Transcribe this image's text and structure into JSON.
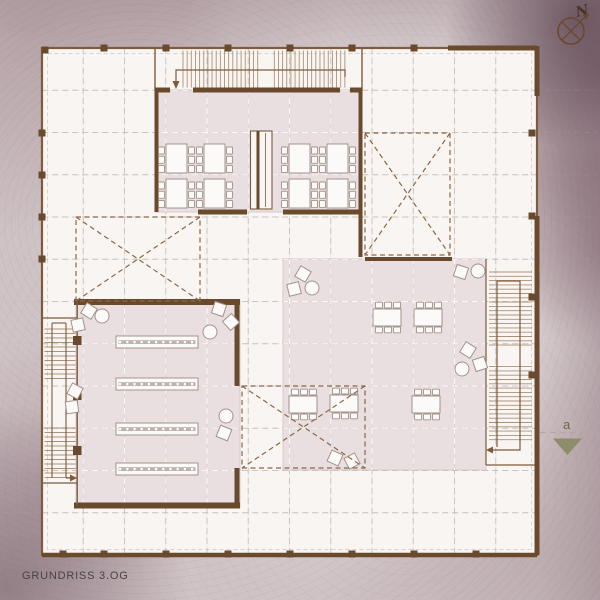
{
  "title": {
    "label": "GRUNDRISS 3.OG"
  },
  "compass": {
    "label": "N"
  },
  "section_marker": {
    "label": "a"
  },
  "colors": {
    "background": "#cfc3c5",
    "floor": "#f8f5f3",
    "room_shade": "#e9dee0",
    "room_edge": "#d8cbcc",
    "wall": "#7d5b3c",
    "wall_dark": "#6a4a2d",
    "tread": "#9e8164",
    "grid": "#c9bcb8",
    "grid_white": "#ffffff",
    "facade_dash": "#d8cdc9",
    "void_dash": "#8a6847",
    "furniture_stroke": "#a3938a",
    "furniture_fill": "#fcfaf9",
    "table_band": "#beb3af",
    "marker_olive": "#8a8b68",
    "marker_line": "#b3a7a3",
    "label_text": "#474340",
    "compass_text": "#46362c",
    "marker_text": "#6f6748"
  }
}
